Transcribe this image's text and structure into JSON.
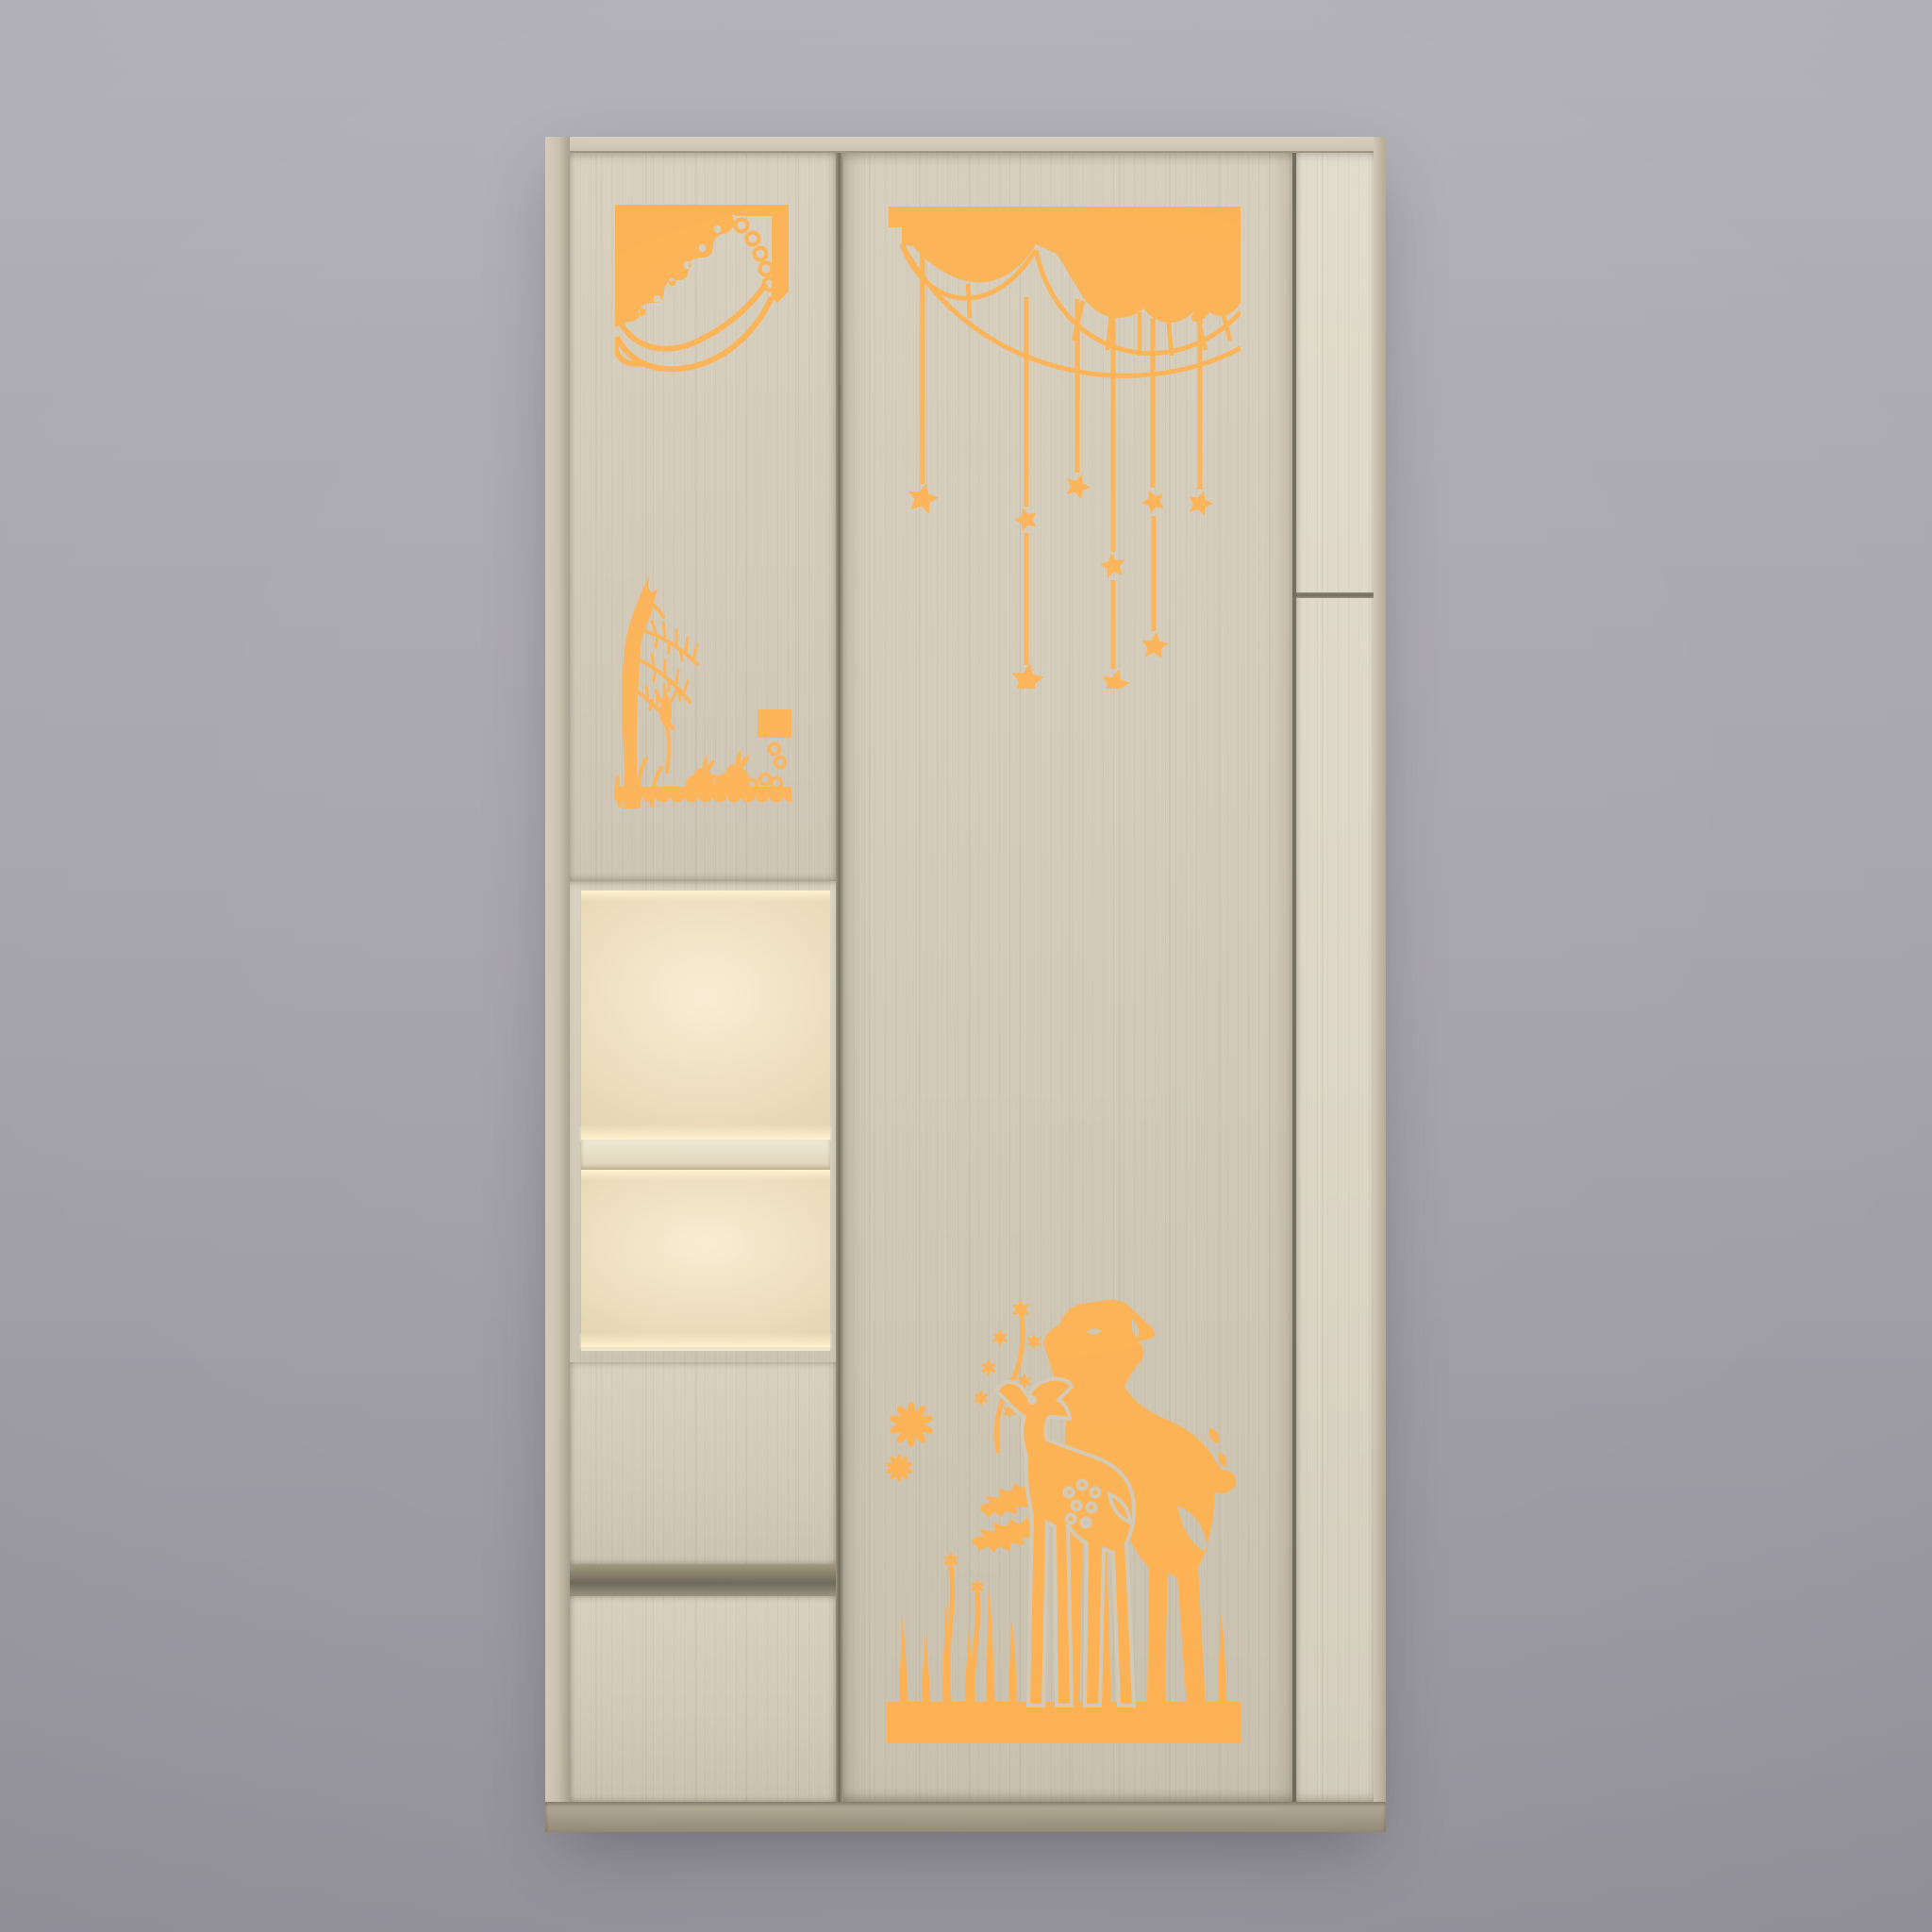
{
  "meta": {
    "kind": "3d-furniture-product-render",
    "description": "Front view of a two-door children's wardrobe in light ash wood, decorated with amber paper-cut style decals and an open display niche with warm edge lighting, on a neutral gray studio background"
  },
  "colors": {
    "accent": "#FCB254",
    "bg-top": "#B3B1B9",
    "bg-mid": "#A6A4AC",
    "bg-bottom": "#96949D",
    "wood-face": "#D5CCBA",
    "wood-panel-light": "#E0D9C8",
    "wood-band": "#CFC6B3",
    "wood-edge": "#CFC4AB",
    "wood-edge-dark": "#A89F8B",
    "gap": "#6F6A5B",
    "niche-warm": "#F8EDD3",
    "niche-mid": "#EADAB8",
    "niche-deep": "#DCCBA5",
    "niche-glow": "#FFF2CC",
    "base-dark": "#958C78"
  },
  "cabinet": {
    "label": "kids wardrobe with illuminated display niche",
    "doors": 2,
    "drawers": 2,
    "niche_compartments": 2,
    "side_panel_split": 1,
    "sections": [
      {
        "id": "left-door",
        "type": "hinged door",
        "decals": [
          "lace-canopy-corner",
          "sapling-and-rabbits"
        ]
      },
      {
        "id": "display-niche",
        "type": "open shelves",
        "lighting": "warm LED edge light"
      },
      {
        "id": "upper-drawer",
        "type": "drawer"
      },
      {
        "id": "lower-drawer",
        "type": "drawer"
      },
      {
        "id": "right-door",
        "type": "hinged door",
        "decals": [
          "star-garland-valance",
          "deer-meadow"
        ]
      },
      {
        "id": "side-panel",
        "type": "fixed panel with horizontal groove"
      }
    ]
  },
  "decals": [
    {
      "id": "lace-canopy-corner",
      "name": "lace canopy corner",
      "motif": "scalloped lace corner with swag curves and curl",
      "color": "#FCB254"
    },
    {
      "id": "star-garland-valance",
      "name": "star garland valance",
      "motif": "swag valance with hanging strings and stars",
      "strings": 6,
      "stars": 9,
      "color": "#FCB254"
    },
    {
      "id": "sapling-and-rabbits",
      "name": "sapling and rabbits",
      "motif": "young tree with fern fronds, wheat spike, grass and two rabbits on scalloped lace ground",
      "rabbits": 2,
      "color": "#FCB254"
    },
    {
      "id": "deer-meadow",
      "name": "deer meadow",
      "motif": "doe and spotted fawn among wildflowers and grass on a solid ground band",
      "deer": 2,
      "color": "#FCB254"
    }
  ]
}
